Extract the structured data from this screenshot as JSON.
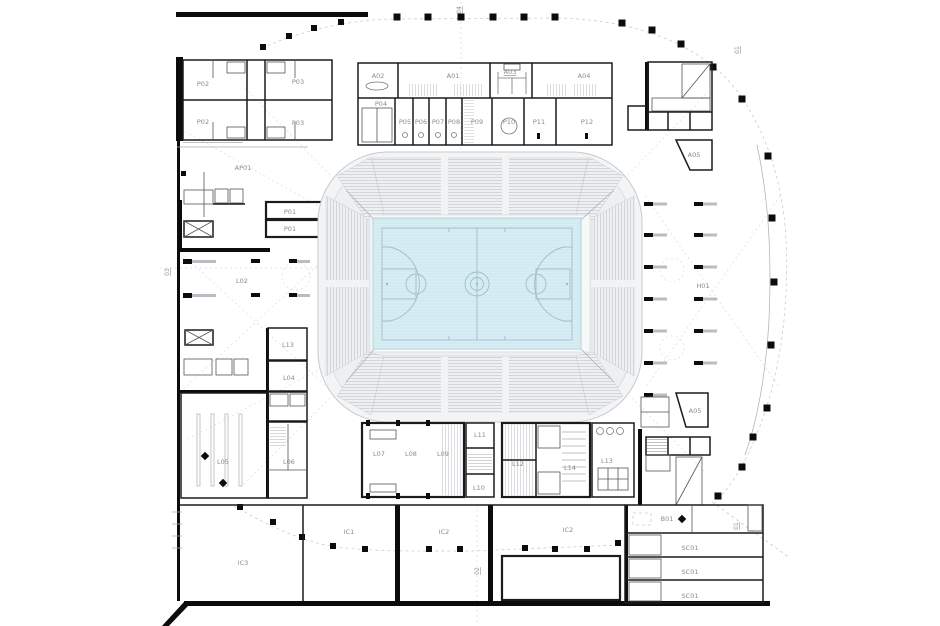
{
  "theme": {
    "background": "#ffffff",
    "wall_color": "#0c0c0c",
    "label_color": "#8a8a8a",
    "court_fill": "#d9edf4",
    "court_line": "#9cbecb",
    "court_border": "#b3d2dc",
    "seating_fill": "#f2f4f6",
    "bowl_outline": "#c6cbd0"
  },
  "labels": [
    {
      "label": "P02",
      "x": 203,
      "y": 86
    },
    {
      "label": "P02",
      "x": 203,
      "y": 124
    },
    {
      "label": "P03",
      "x": 298,
      "y": 84
    },
    {
      "label": "P03",
      "x": 298,
      "y": 125
    },
    {
      "label": "A02",
      "x": 378,
      "y": 78
    },
    {
      "label": "A01",
      "x": 453,
      "y": 78
    },
    {
      "label": "A03",
      "x": 510,
      "y": 74,
      "underline": true
    },
    {
      "label": "A04",
      "x": 584,
      "y": 78
    },
    {
      "label": "P04",
      "x": 381,
      "y": 106
    },
    {
      "label": "P05",
      "x": 405,
      "y": 124
    },
    {
      "label": "P06",
      "x": 421,
      "y": 124
    },
    {
      "label": "P07",
      "x": 438,
      "y": 124
    },
    {
      "label": "P08",
      "x": 454,
      "y": 124
    },
    {
      "label": "P09",
      "x": 477,
      "y": 124
    },
    {
      "label": "P10",
      "x": 509,
      "y": 124
    },
    {
      "label": "P11",
      "x": 539,
      "y": 124
    },
    {
      "label": "P12",
      "x": 587,
      "y": 124
    },
    {
      "label": "AP01",
      "x": 243,
      "y": 170
    },
    {
      "label": "P01",
      "x": 290,
      "y": 214
    },
    {
      "label": "P01",
      "x": 290,
      "y": 231
    },
    {
      "label": "L02",
      "x": 242,
      "y": 283
    },
    {
      "label": "A05",
      "x": 694,
      "y": 157
    },
    {
      "label": "H01",
      "x": 703,
      "y": 288
    },
    {
      "label": "A05",
      "x": 695,
      "y": 413
    },
    {
      "label": "L13",
      "x": 288,
      "y": 347
    },
    {
      "label": "L04",
      "x": 289,
      "y": 380
    },
    {
      "label": "L05",
      "x": 223,
      "y": 464
    },
    {
      "label": "L06",
      "x": 289,
      "y": 464
    },
    {
      "label": "L07",
      "x": 379,
      "y": 456
    },
    {
      "label": "L08",
      "x": 411,
      "y": 456
    },
    {
      "label": "L09",
      "x": 443,
      "y": 456
    },
    {
      "label": "L11",
      "x": 480,
      "y": 437
    },
    {
      "label": "L10",
      "x": 479,
      "y": 490
    },
    {
      "label": "L12",
      "x": 518,
      "y": 466
    },
    {
      "label": "L14",
      "x": 570,
      "y": 470
    },
    {
      "label": "L13",
      "x": 607,
      "y": 463
    },
    {
      "label": "IC3",
      "x": 243,
      "y": 565
    },
    {
      "label": "IC1",
      "x": 349,
      "y": 534
    },
    {
      "label": "IC2",
      "x": 444,
      "y": 534
    },
    {
      "label": "IC2",
      "x": 568,
      "y": 532
    },
    {
      "label": "B01",
      "x": 667,
      "y": 521
    },
    {
      "label": "SC01",
      "x": 690,
      "y": 550
    },
    {
      "label": "SC01",
      "x": 690,
      "y": 574
    },
    {
      "label": "SC01",
      "x": 690,
      "y": 598
    },
    {
      "label": "03",
      "x": 169,
      "y": 272,
      "kind": "grid",
      "rotate": true,
      "underline": true
    },
    {
      "label": "04",
      "x": 461,
      "y": 10,
      "kind": "grid",
      "rotate": true,
      "underline": true
    },
    {
      "label": "01",
      "x": 739,
      "y": 50,
      "kind": "grid",
      "rotate": true,
      "underline": true
    },
    {
      "label": "01",
      "x": 738,
      "y": 526,
      "kind": "grid",
      "rotate": true,
      "underline": true
    },
    {
      "label": "02",
      "x": 479,
      "y": 571,
      "kind": "grid",
      "rotate": true,
      "underline": true
    }
  ]
}
